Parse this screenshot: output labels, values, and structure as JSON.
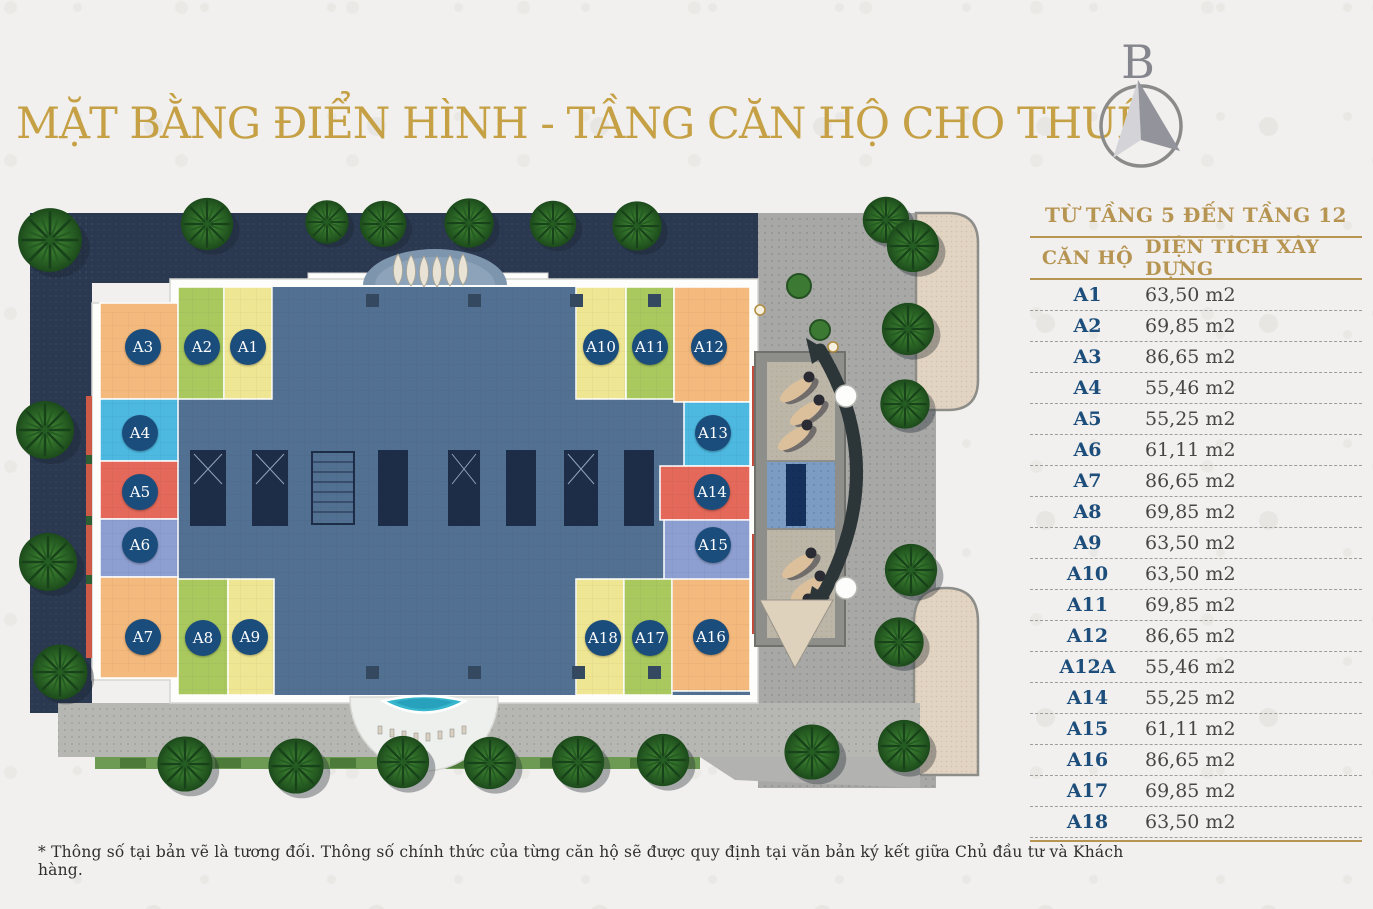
{
  "page": {
    "title": "MẶT BẰNG ĐIỂN HÌNH - TẦNG CĂN HỘ CHO THUÊ",
    "footnote": "* Thông số tại bản vẽ là tương đối. Thông số chính thức của từng căn hộ sẽ được quy định tại văn bản ký kết giữa Chủ đầu tư và Khách hàng."
  },
  "compass": {
    "label": "B"
  },
  "table": {
    "caption": "TỪ TẦNG 5 ĐẾN TẦNG 12",
    "columns": [
      "CĂN HỘ",
      "DIỆN TÍCH XÂY DỰNG"
    ],
    "rows": [
      {
        "unit": "A1",
        "area": "63,50 m2"
      },
      {
        "unit": "A2",
        "area": "69,85 m2"
      },
      {
        "unit": "A3",
        "area": "86,65 m2"
      },
      {
        "unit": "A4",
        "area": "55,46 m2"
      },
      {
        "unit": "A5",
        "area": "55,25 m2"
      },
      {
        "unit": "A6",
        "area": "61,11 m2"
      },
      {
        "unit": "A7",
        "area": "86,65 m2"
      },
      {
        "unit": "A8",
        "area": "69,85 m2"
      },
      {
        "unit": "A9",
        "area": "63,50 m2"
      },
      {
        "unit": "A10",
        "area": "63,50 m2"
      },
      {
        "unit": "A11",
        "area": "69,85 m2"
      },
      {
        "unit": "A12",
        "area": "86,65 m2"
      },
      {
        "unit": "A12A",
        "area": "55,46 m2"
      },
      {
        "unit": "A14",
        "area": "55,25 m2"
      },
      {
        "unit": "A15",
        "area": "61,11 m2"
      },
      {
        "unit": "A16",
        "area": "86,65 m2"
      },
      {
        "unit": "A17",
        "area": "69,85 m2"
      },
      {
        "unit": "A18",
        "area": "63,50 m2"
      }
    ]
  },
  "plan": {
    "labels": [
      "A3",
      "A2",
      "A1",
      "A4",
      "A5",
      "A6",
      "A7",
      "A8",
      "A9",
      "A10",
      "A11",
      "A12",
      "A13",
      "A14",
      "A15",
      "A18",
      "A17",
      "A16"
    ]
  },
  "colors": {
    "title_gold": "#c5a044",
    "table_gold": "#b69452",
    "badge_blue": "#1b4d7c",
    "core_slate": "#527092",
    "unit_orange": "#f4b97c",
    "unit_green": "#a9c95f",
    "unit_yellow": "#efe693",
    "unit_cyan": "#4db8e0",
    "unit_red": "#e4695a",
    "unit_periwinkle": "#8d9fd1",
    "landscape_navy": "#2a3850",
    "pool_turquoise": "#35b6cc"
  }
}
